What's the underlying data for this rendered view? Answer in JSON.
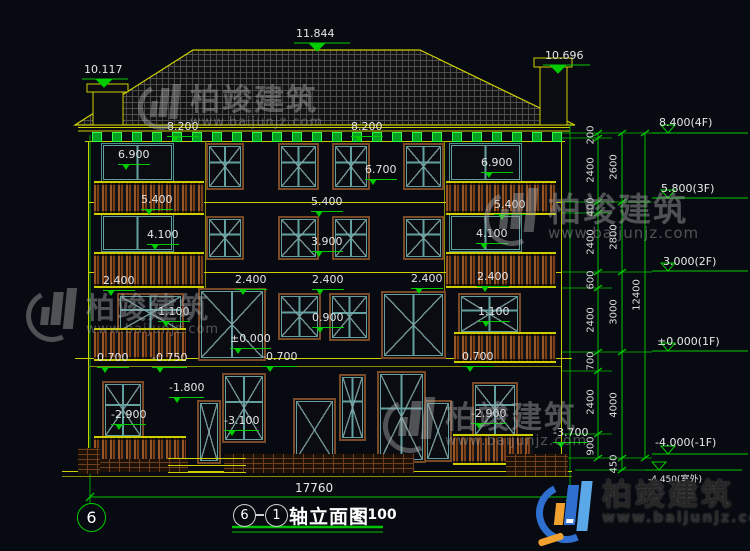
{
  "drawing": {
    "title": {
      "axis_left": "6",
      "axis_right": "1",
      "name": "轴立面图",
      "scale": "1:100"
    },
    "axis_bubble_left": "6",
    "overall_width_dim": "17760"
  },
  "roof_labels": {
    "ridge": "11.844",
    "chimney_left": "10.117",
    "chimney_right": "10.696",
    "eave_left": "8.200",
    "eave_right": "8.200"
  },
  "facade_labels": [
    {
      "t": "11.844",
      "x": 296,
      "y": 28,
      "cls": "plain"
    },
    {
      "t": "10.117",
      "x": 84,
      "y": 64,
      "cls": "plain"
    },
    {
      "t": "10.696",
      "x": 545,
      "y": 50,
      "cls": "plain"
    },
    {
      "t": "8.200",
      "x": 167,
      "y": 121
    },
    {
      "t": "8.200",
      "x": 351,
      "y": 121
    },
    {
      "t": "6.900",
      "x": 118,
      "y": 149
    },
    {
      "t": "6.700",
      "x": 365,
      "y": 164
    },
    {
      "t": "6.900",
      "x": 481,
      "y": 157
    },
    {
      "t": "5.400",
      "x": 141,
      "y": 194
    },
    {
      "t": "5.400",
      "x": 311,
      "y": 196
    },
    {
      "t": "5.400",
      "x": 494,
      "y": 199
    },
    {
      "t": "4.100",
      "x": 147,
      "y": 229
    },
    {
      "t": "3.900",
      "x": 311,
      "y": 236
    },
    {
      "t": "4.100",
      "x": 476,
      "y": 228
    },
    {
      "t": "2.400",
      "x": 103,
      "y": 275
    },
    {
      "t": "2.400",
      "x": 235,
      "y": 274
    },
    {
      "t": "2.400",
      "x": 312,
      "y": 274
    },
    {
      "t": "2.400",
      "x": 411,
      "y": 273
    },
    {
      "t": "2.400",
      "x": 477,
      "y": 271
    },
    {
      "t": "1.100",
      "x": 158,
      "y": 306
    },
    {
      "t": "1.100",
      "x": 478,
      "y": 306
    },
    {
      "t": "0.900",
      "x": 312,
      "y": 312
    },
    {
      "t": "±0.000",
      "x": 230,
      "y": 333
    },
    {
      "t": "0.700",
      "x": 97,
      "y": 352
    },
    {
      "t": "-0.750",
      "x": 152,
      "y": 352
    },
    {
      "t": "-0.700",
      "x": 262,
      "y": 351
    },
    {
      "t": "0.700",
      "x": 462,
      "y": 351
    },
    {
      "t": "-1.800",
      "x": 169,
      "y": 382
    },
    {
      "t": "-2.900",
      "x": 111,
      "y": 409
    },
    {
      "t": "-3.100",
      "x": 224,
      "y": 415
    },
    {
      "t": "-2.900",
      "x": 471,
      "y": 408
    },
    {
      "t": "-3.700",
      "x": 553,
      "y": 427
    }
  ],
  "floor_markers": [
    {
      "t": "8.400(4F)",
      "x": 659,
      "y": 116
    },
    {
      "t": "5.800(3F)",
      "x": 661,
      "y": 182
    },
    {
      "t": "3.000(2F)",
      "x": 663,
      "y": 255
    },
    {
      "t": "±0.000(1F)",
      "x": 657,
      "y": 335
    },
    {
      "t": "-4.000(-1F)",
      "x": 655,
      "y": 436
    },
    {
      "t": "-4.450(室外)",
      "x": 648,
      "y": 472,
      "small": true
    }
  ],
  "dim_chains": {
    "inner": [
      {
        "t": "200",
        "y": 135
      },
      {
        "t": "2400",
        "y": 170
      },
      {
        "t": "400",
        "y": 207
      },
      {
        "t": "2400",
        "y": 242
      },
      {
        "t": "600",
        "y": 280
      },
      {
        "t": "2400",
        "y": 320
      },
      {
        "t": "700",
        "y": 361
      },
      {
        "t": "2400",
        "y": 402
      },
      {
        "t": "900",
        "y": 446
      }
    ],
    "outer": [
      {
        "t": "2600",
        "y": 167
      },
      {
        "t": "2800",
        "y": 237
      },
      {
        "t": "3000",
        "y": 312
      },
      {
        "t": "4000",
        "y": 405
      },
      {
        "t": "450",
        "y": 464
      }
    ],
    "total": {
      "t": "12400",
      "y": 295
    }
  },
  "watermark": {
    "brand": "柏竣建筑",
    "url": "www.baijunjz.com"
  },
  "watermark_positions": [
    {
      "x": 138,
      "y": 84,
      "glyph": 46,
      "font": 30
    },
    {
      "x": 484,
      "y": 188,
      "glyph": 58,
      "font": 33
    },
    {
      "x": 26,
      "y": 288,
      "glyph": 54,
      "font": 29
    },
    {
      "x": 383,
      "y": 397,
      "glyph": 56,
      "font": 31
    }
  ],
  "logo": {
    "brand": "柏竣建筑",
    "url": "www.baijunjz.com"
  },
  "colors": {
    "background": "#070a10",
    "dimension_green": "#00cc00",
    "wall_yellow": "#cfcf00",
    "frame_brown": "#7a4a28",
    "frame_teal": "#62a0a0",
    "text_white": "#e5e5e5",
    "logo_blue": "#2e6fd0",
    "logo_light_blue": "#5aa8e8",
    "logo_orange": "#f0a230",
    "watermark_gray": "#a8a8a8",
    "eave_square_green": "#2fff44"
  }
}
